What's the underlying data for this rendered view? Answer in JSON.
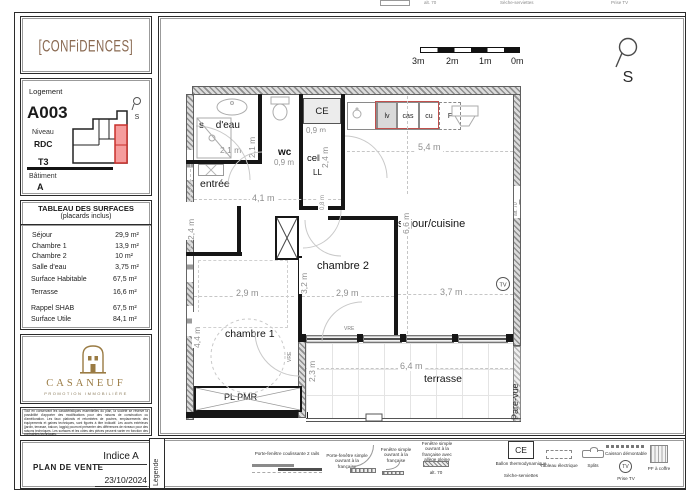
{
  "page": {
    "top_cutoff": {
      "alt70": "alt. 70",
      "seche": "Sèche-serviettes",
      "prise_tv": "Prise TV"
    }
  },
  "sidebar": {
    "logo_text": "[CONFiDENCES]",
    "logement": {
      "label": "Logement",
      "unit": "A003",
      "level_label": "Niveau",
      "level": "RDC",
      "type": "T3",
      "building_label": "Bâtiment",
      "building": "A",
      "north_letter": "S"
    },
    "surfaces": {
      "title": "TABLEAU DES SURFACES",
      "subtitle": "(placards inclus)",
      "rows": [
        {
          "label": "Séjour",
          "value": "29,9 m²"
        },
        {
          "label": "Chambre 1",
          "value": "13,9 m²"
        },
        {
          "label": "Chambre 2",
          "value": "10 m²"
        },
        {
          "label": "Salle d'eau",
          "value": "3,75 m²"
        }
      ],
      "totals": [
        {
          "label": "Surface Habitable",
          "value": "67,5 m²"
        },
        {
          "label": "Terrasse",
          "value": "16,6 m²"
        }
      ],
      "recap": [
        {
          "label": "Rappel SHAB",
          "value": "67,5 m²"
        },
        {
          "label": "Surface Utile",
          "value": "84,1 m²"
        }
      ]
    },
    "brand": {
      "name": "CASANEUF",
      "tagline": "PROMOTION IMMOBILIÈRE"
    },
    "disclaimer": "Tout en conservant les caractéristiques essentielles du plan, la société se réserve la possibilité d'apporter des modifications pour des raisons de construction ou d'amélioration. Les faux plafonds et retombées de poutres, emplacements des équipements et gaines techniques, sont figurés à titre indicatif. Les accès extérieurs (jardin, terrasse, balcon, loggia) pourront présenter des différences de niveaux pour des raisons techniques. Les surfaces et les côtes des pièces peuvent varier en fonction des contraintes techniques.",
    "footer": {
      "title": "PLAN DE VENTE",
      "indice": "Indice A",
      "date": "23/10/2024"
    }
  },
  "plan": {
    "scale_labels": [
      "3m",
      "2m",
      "1m",
      "0m"
    ],
    "north_letter": "S",
    "rooms": {
      "sdb": "s d'eau",
      "wc": "wc",
      "entree": "entrée",
      "cell": "cell.",
      "ll": "LL",
      "ce": "CE",
      "sejour": "séjour/cuisine",
      "ch1": "chambre 1",
      "ch2": "chambre 2",
      "terrasse": "terrasse",
      "pl_pmr": "PL PMR",
      "pare_vue": "Pare-vue",
      "tv": "TV",
      "vre": "VRE",
      "alt70": "alt. 70"
    },
    "kitchen_labels": [
      "lv",
      "cas",
      "cu",
      "F"
    ],
    "dims": {
      "sdb_w": "2,1 m",
      "sdb_h": "2,1 m",
      "wc_w": "0,9 m",
      "ce_w": "0,9 m",
      "cell_h": "2,4 m",
      "hall_w": "4,1 m",
      "hall_h": "2,4 m",
      "hall_h2": "0,8 m",
      "sejour_w": "5,4 m",
      "sejour_h": "6,6 m",
      "sejour_w2": "3,7 m",
      "ch2_w": "2,9 m",
      "ch2_h": "3,2 m",
      "ch1_w": "2,9 m",
      "ch1_h": "4,4 m",
      "terrasse_w": "6,4 m",
      "terrasse_h": "2,3 m"
    }
  },
  "legend": {
    "tab": "Légende",
    "items": [
      {
        "label": "Porte-fenêtre coulissante 2 rails"
      },
      {
        "label": "Porte-fenêtre simple ouvrant à la française"
      },
      {
        "label": "Fenêtre simple ouvrant à la française"
      },
      {
        "label": "Fenêtre simple ouvrant à la française avec allège pleine",
        "note": "alt. 70"
      },
      {
        "symbol_text": "CE",
        "label": "Ballon thermodynamique",
        "label2": "Sèche-serviettes"
      },
      {
        "label": "Tableau électrique"
      },
      {
        "label": "Splits"
      },
      {
        "label": "Caisson démontable",
        "symbol_text": "TV",
        "label2": "Prise TV"
      },
      {
        "label": "PF à coffre"
      }
    ]
  },
  "colors": {
    "accent_red": "#c9302c",
    "unit_fill": "#f59d9d",
    "brand_brown": "#8a6a52",
    "casaneuf_gold": "#9a7b43"
  }
}
